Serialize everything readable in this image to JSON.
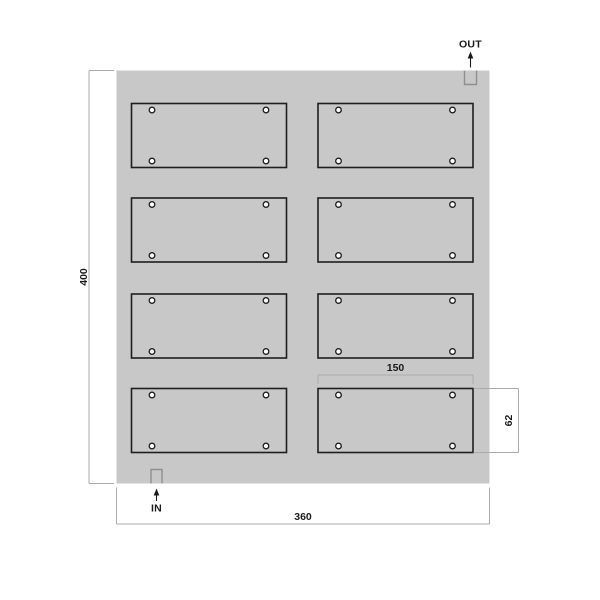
{
  "drawing": {
    "port_labels": {
      "out": "OUT",
      "in": "IN"
    },
    "dimensions": {
      "plate_height": "400",
      "plate_width": "360",
      "panel_width": "150",
      "panel_height": "62"
    },
    "panel_grid": {
      "rows": 4,
      "cols": 2,
      "holes_per_panel": 4
    },
    "colors": {
      "plate_fill": "#c7c8c7",
      "panel_stroke": "#1e1e1e",
      "hole_fill": "#ffffff",
      "dimension_line": "#ababab",
      "notch_stroke": "#8f8f8f",
      "text_color": "#1a1a1a",
      "background": "#ffffff"
    }
  }
}
